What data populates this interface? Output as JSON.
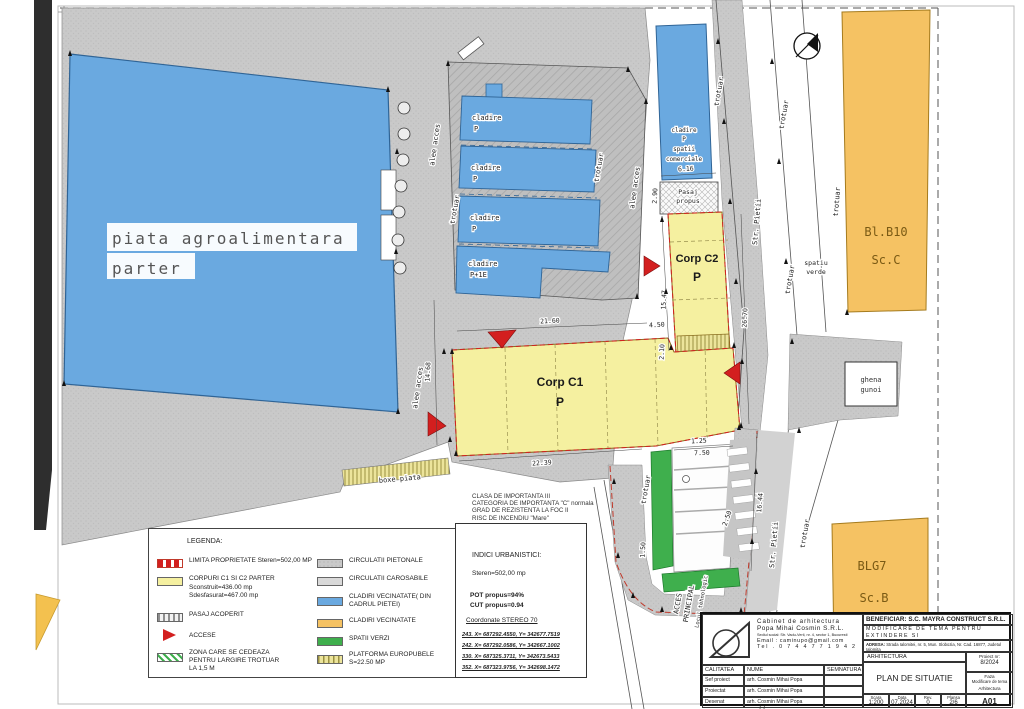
{
  "plan": {
    "labels": {
      "piata1": "piata agroalimentara",
      "piata2": "parter",
      "cladire": "cladire",
      "p": "P",
      "p1e": "P+1E",
      "spatii": "spatii",
      "comerciale": "comerciale",
      "pasaj1": "Pasaj",
      "pasaj2": "propus",
      "corp_c1": "Corp C1",
      "corp_c2": "Corp C2",
      "boxe": "boxe piata",
      "ghena1": "ghena",
      "ghena2": "gunoi",
      "bl_b10": "Bl.B10",
      "sc_c": "Sc.C",
      "blg7": "BLG7",
      "sc_b": "Sc.B",
      "spatiu1": "spatiu",
      "spatiu2": "verde",
      "trotuar": "trotuar",
      "alee": "alee acces",
      "str_pietii": "Str. Pietii",
      "acces1": "ACCES",
      "acces2": "PRINCIPAL",
      "locul": "Locul tehnologic"
    },
    "dims": {
      "d1": "21.60",
      "d2": "4.50",
      "d3": "22.39",
      "d4": "14.68",
      "d5": "15.47",
      "d6": "26.70",
      "d7": "2.10",
      "d8": "6.16",
      "d9": "7.50",
      "d10": "2.50",
      "d11": "16.44",
      "d12": "1.50",
      "d13": "1.25",
      "d14": "2.90"
    },
    "notes": [
      "CLASA DE IMPORTANTA III",
      "CATEGORIA DE IMPORTANTA \"C\" normala",
      "GRAD DE REZISTENTA LA FOC II",
      "RISC DE INCENDIU \"Mare\""
    ]
  },
  "legend": {
    "title": "LEGENDA:",
    "left": [
      {
        "lines": [
          "LIMITA PROPRIETATE  Steren=502,00 MP"
        ]
      },
      {
        "lines": [
          "CORPURI C1 SI C2 PARTER",
          "Sconstruit=436.00 mp",
          "Sdesfasurat=467.00 mp"
        ]
      },
      {
        "lines": [
          "PASAJ ACOPERIT"
        ]
      },
      {
        "lines": [
          "ACCESE"
        ]
      },
      {
        "lines": [
          "ZONA CARE SE CEDEAZA",
          "PENTRU LARGIRE TROTUAR",
          "LA 1,5 M"
        ]
      }
    ],
    "right": [
      {
        "lines": [
          "CIRCULATII PIETONALE"
        ]
      },
      {
        "lines": [
          "CIRCULATII CAROSABILE"
        ]
      },
      {
        "lines": [
          "CLADIRI VECINATATE( DIN",
          "CADRUL PIETEI)"
        ]
      },
      {
        "lines": [
          "CLADIRI VECINATATE"
        ]
      },
      {
        "lines": [
          "SPATII VERZI"
        ]
      },
      {
        "lines": [
          "PLATFORMA EUROPUBELE",
          "S=22.50 MP"
        ]
      }
    ]
  },
  "indici": {
    "title": "INDICI URBANISTICI:",
    "steren": "Steren=502,00 mp",
    "pot": "POT propus=94%",
    "cut": "CUT propus=0.94",
    "coord_title": "Coordonate STEREO 70",
    "coords": [
      "243.  X= 687292.4550, Y= 342677.7519",
      "242.  X= 687292.0586, Y= 342667.1002",
      "330.  X= 687325.3711, Y= 342673.5433",
      "352.  X= 687323.9756, Y= 342698.1472"
    ]
  },
  "titleblock": {
    "firm1": "Cabinet de arhitectura",
    "firm2": "Popa Mihai Cosmin S.R.L.",
    "firm_addr": "Sediul social: Str. Vadu-Verii, nr. 4, sector 1, Bucuresti",
    "firm_email": "Email : caminupo@gmail.com",
    "firm_tel": "Tel . 0 7 4 4 7 7 1 9 4 2",
    "beneficiar": "BENEFICIAR: S.C.  MAYRA CONSTRUCT S.R.L.",
    "proiect1": "MODIFICARE DE TEMA PENTRU EXTINDERE SI",
    "proiect2": "MODERNIZARE SPATIU COMERCIAL",
    "adresa_label": "ADRESA:",
    "adresa": "Strada Ialomitei, nr. 5, Mun. Slobozia, Nr. Cad. 16877, Judetul Ialomita",
    "specialitate": "ARHITECTURA",
    "proiect_nr_label": "Proiect nr:",
    "proiect_nr": "8/2024",
    "plan_title": "PLAN DE SITUATIE",
    "faza_label": "Faza",
    "faza1": "Modificare de tema",
    "faza2": "Arhitectura",
    "code": "A01",
    "col_calitatea": "CALITATEA",
    "col_nume": "NUME",
    "col_semnatura": "SEMNATURA",
    "rows": [
      {
        "rol": "Sef proiect",
        "nume": "arh. Cosmin Mihai Popa"
      },
      {
        "rol": "Proiectat",
        "nume": "arh. Cosmin Mihai Popa"
      },
      {
        "rol": "Desenat",
        "nume": "arh. Cosmin Mihai Popa"
      }
    ],
    "scara_label": "Scara",
    "scara": "1:200",
    "data_label": "Data",
    "data": "07.2024",
    "rev_label": "Rev.",
    "rev": "0",
    "plansa_label": "Plansa",
    "plansa": "2/6"
  },
  "colors": {
    "blue": "#6aa9e0",
    "yellow": "#f5f0a0",
    "orange": "#f5c263",
    "green": "#3faf4d",
    "red": "#d31f1f",
    "gray": "#c9c9c9"
  }
}
